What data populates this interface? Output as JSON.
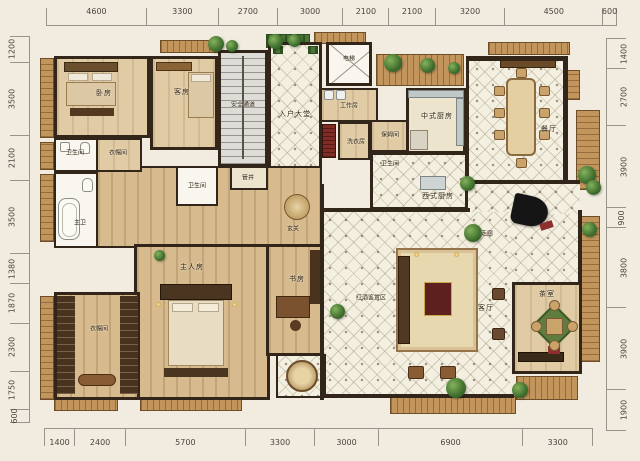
{
  "rulers": {
    "top": {
      "values": [
        4600,
        3300,
        2700,
        3000,
        2100,
        2100,
        3200,
        4500,
        600
      ]
    },
    "bottom": {
      "values": [
        1400,
        2400,
        5700,
        3300,
        3000,
        6900,
        3300
      ]
    },
    "left": {
      "values": [
        1200,
        3500,
        2100,
        3500,
        1380,
        1870,
        2300,
        1750,
        600
      ]
    },
    "right": {
      "values": [
        1400,
        2700,
        3900,
        900,
        3800,
        3900,
        1900
      ]
    }
  },
  "rooms": {
    "bedroom": {
      "label": "卧房"
    },
    "guest_room": {
      "label": "客房"
    },
    "safety_passage": {
      "label": "安全通道"
    },
    "entrance_hall": {
      "label": "入户大堂"
    },
    "elevator": {
      "label": "电梯"
    },
    "work_room": {
      "label": "工作房"
    },
    "laundry": {
      "label": "洗衣房"
    },
    "nanny_room": {
      "label": "保姆间"
    },
    "bath_service": {
      "label": "卫生间"
    },
    "chinese_kitchen": {
      "label": "中式厨房"
    },
    "western_kitchen": {
      "label": "西式厨房"
    },
    "dining_room": {
      "label": "餐厅"
    },
    "bath_top": {
      "label": "卫生间"
    },
    "closet_top": {
      "label": "衣帽间"
    },
    "master_bath": {
      "label": "主卫"
    },
    "bath_mid": {
      "label": "卫生间"
    },
    "pipe_shaft": {
      "label": "管井"
    },
    "foyer": {
      "label": "玄关"
    },
    "corridor": {
      "label": "走廊"
    },
    "master_bedroom": {
      "label": "主人房"
    },
    "study": {
      "label": "书房"
    },
    "master_closet": {
      "label": "衣帽间"
    },
    "wine_area": {
      "label": "红酒鉴赏区"
    },
    "living_room": {
      "label": "客厅"
    },
    "tea_room": {
      "label": "茶室"
    }
  },
  "colors": {
    "wall": "#32261a",
    "wood_floor": "#d7bb8e",
    "tile_floor": "#f4f0e1",
    "deck": "#c2955c",
    "plant_green": "#3f6f2e",
    "accent_red": "#8e2f2f",
    "background": "#f1ecdf"
  }
}
